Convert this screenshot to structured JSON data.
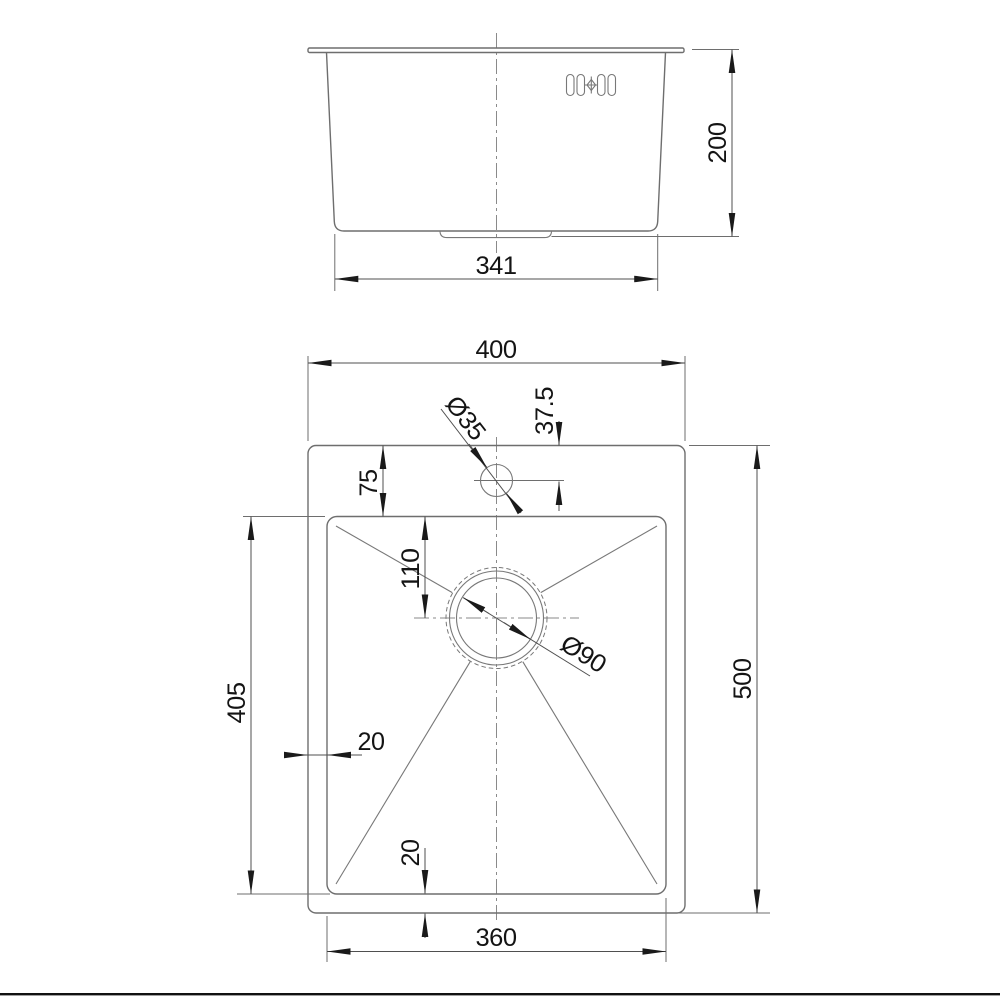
{
  "drawing": {
    "type": "kitchen-sink-technical-drawing",
    "views": [
      "front-elevation",
      "plan-view"
    ],
    "colors": {
      "background": "#ffffff",
      "object_line": "#6e6e6e",
      "dimension_line": "#4f4f4f",
      "centerline": "#8a8a8a",
      "text": "#141414",
      "bottom_rule": "#111111"
    },
    "icons": {
      "tap_marking": "tap-slots-and-diamond-icon"
    }
  },
  "labels": {
    "front": {
      "bottom_width": "341",
      "height": "200"
    },
    "plan": {
      "overall_width": "400",
      "overall_height": "500",
      "bowl_width": "360",
      "bowl_height": "405",
      "rim_top": "75",
      "drain_offset": "110",
      "rim_left": "20",
      "rim_bottom": "20",
      "tap_offset": "37.5",
      "tap_hole_diameter": "Ø35",
      "drain_diameter": "Ø90"
    }
  }
}
